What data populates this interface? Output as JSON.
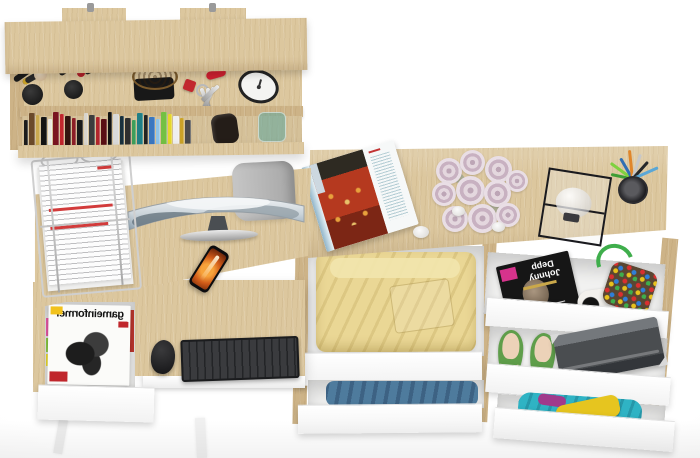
{
  "scene": {
    "type": "product-photo",
    "description": "Top-down view of a light-oak home office set: wall shelf with books and accessories, desk with curved monitor and pull-out keyboard tray, chest with open drawers of clothes and accessories",
    "colors": {
      "background": "#ffffff",
      "wood": "#dcc79e",
      "wood_dark": "#cdb387",
      "drawer_front": "#fbfbfb",
      "yellow_clothes": "#ead795",
      "blue_clothes": "#4e7b9d",
      "teal_clothes": "#2fb3c4",
      "shoe_green": "#5f9e4a"
    }
  },
  "wall_shelf": {
    "items": [
      "makeup-brushes",
      "lipsticks",
      "wicker-basket",
      "key-set",
      "red-pocket-knife",
      "alarm-clock",
      "books",
      "dark-pouch",
      "green-glass-jar"
    ],
    "book_colors": [
      "#1c1c1c",
      "#6b4a2a",
      "#caa94f",
      "#141414",
      "#e9e6df",
      "#7a1520",
      "#c0262c",
      "#32130f",
      "#8c1f26",
      "#1a1a1a",
      "#d8d4cc",
      "#3c3c3c",
      "#b2262c",
      "#5a0f14",
      "#111111",
      "#d9d9d9",
      "#19303c",
      "#2e2e2e",
      "#3e9e5a",
      "#207f86",
      "#232323",
      "#3a77c0",
      "#8fc3e8",
      "#74c043",
      "#e6d62a",
      "#efefef",
      "#caa227",
      "#4b4b4b"
    ]
  },
  "desk": {
    "monitor": "curved widescreen showing mountain and cloud landscape",
    "chair": "grey office chair seen from above",
    "paper_tray": "wire letter tray with white documents and red headings",
    "phone": "smartphone with orange flame wallpaper",
    "keyboard": "black wireless keyboard",
    "mouse": "black wireless mouse",
    "drawer_magazine_title": "gameinformer",
    "drawer_contents": "stack of gaming magazines in open drawer"
  },
  "dresser": {
    "top_items": [
      "open-travel-magazine",
      "lavender-rose-bouquet",
      "white-pebbles",
      "black-frame-glass-box",
      "pen-cup"
    ],
    "pen_colors": [
      "#3f9e35",
      "#7fd13f",
      "#2f6fb4",
      "#e0862a",
      "#c8c8c8",
      "#26282a",
      "#5aa7d6"
    ],
    "magazine_title": "Johnny Depp",
    "drawers": [
      {
        "name": "drawer-yellow-clothes",
        "content": "yellow folded clothes"
      },
      {
        "name": "drawer-blue-clothes",
        "content": "blue folded clothes"
      },
      {
        "name": "drawer-magazine-bag",
        "content": "magazine, cow-print fabric and multicolor beaded bag"
      },
      {
        "name": "drawer-shoes-laptop",
        "content": "green ballet flats and grey laptop"
      },
      {
        "name": "drawer-colorful-clothes",
        "content": "teal and yellow clothes"
      }
    ]
  }
}
